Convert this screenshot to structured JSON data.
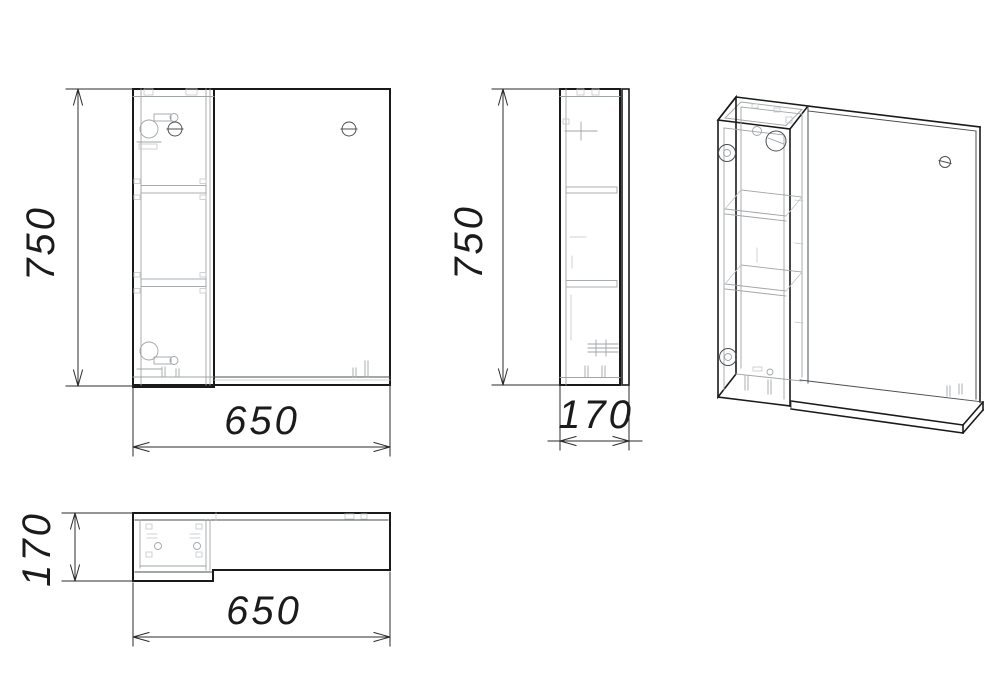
{
  "drawing": {
    "background": "#ffffff",
    "line_color": "#1a1a1a",
    "detail_color": "#9fa4a7",
    "views": {
      "front": {
        "height": "750",
        "width": "650"
      },
      "side": {
        "height": "750",
        "depth": "170"
      },
      "plan": {
        "depth": "170",
        "width": "650"
      }
    }
  }
}
